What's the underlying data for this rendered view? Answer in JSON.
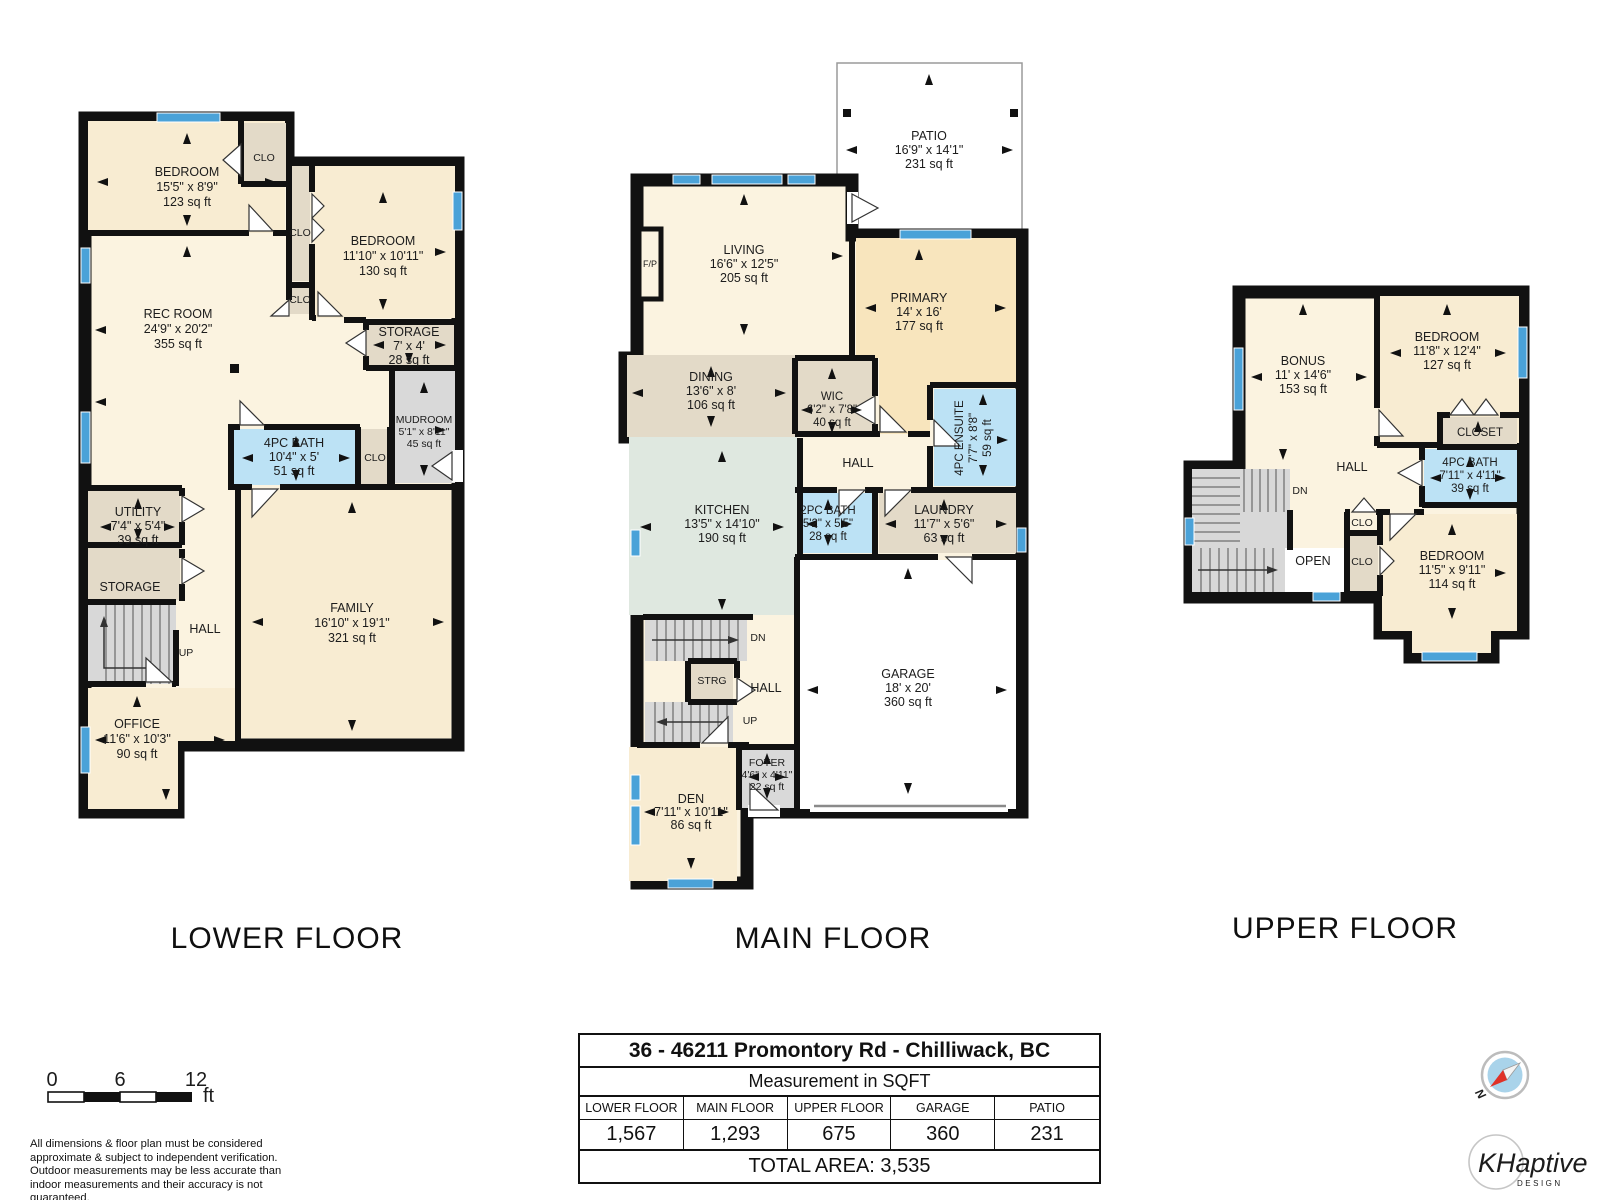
{
  "floors": {
    "lower": {
      "label": "LOWER FLOOR",
      "rooms": {
        "bedroom1": {
          "name": "BEDROOM",
          "dims": "15'5\" x 8'9\"",
          "area": "123 sq ft"
        },
        "clo_bedroom1": {
          "name": "CLO"
        },
        "bedroom2": {
          "name": "BEDROOM",
          "dims": "11'10\" x 10'11\"",
          "area": "130 sq ft"
        },
        "clo_hall_upper": {
          "name": "CLO"
        },
        "clo_hall_lower": {
          "name": "CLO"
        },
        "rec_room": {
          "name": "REC ROOM",
          "dims": "24'9\" x 20'2\"",
          "area": "355 sq ft"
        },
        "storage_right": {
          "name": "STORAGE",
          "dims": "7' x 4'",
          "area": "28 sq ft"
        },
        "mudroom": {
          "name": "MUDROOM",
          "dims": "5'1\" x 8'11\"",
          "area": "45 sq ft"
        },
        "bath": {
          "name": "4PC BATH",
          "dims": "10'4\" x 5'",
          "area": "51 sq ft"
        },
        "clo_bath": {
          "name": "CLO"
        },
        "utility": {
          "name": "UTILITY",
          "dims": "7'4\" x 5'4\"",
          "area": "39 sq ft"
        },
        "storage_left": {
          "name": "STORAGE"
        },
        "hall": {
          "name": "HALL"
        },
        "up": {
          "name": "UP"
        },
        "office": {
          "name": "OFFICE",
          "dims": "11'6\" x 10'3\"",
          "area": "90 sq ft"
        },
        "family": {
          "name": "FAMILY",
          "dims": "16'10\" x 19'1\"",
          "area": "321 sq ft"
        }
      }
    },
    "main": {
      "label": "MAIN FLOOR",
      "rooms": {
        "patio": {
          "name": "PATIO",
          "dims": "16'9\" x 14'1\"",
          "area": "231 sq ft"
        },
        "living": {
          "name": "LIVING",
          "dims": "16'6\" x 12'5\"",
          "area": "205 sq ft"
        },
        "fireplace": {
          "name": "F/P"
        },
        "primary": {
          "name": "PRIMARY",
          "dims": "14' x 16'",
          "area": "177 sq ft"
        },
        "dining": {
          "name": "DINING",
          "dims": "13'6\" x 8'",
          "area": "106 sq ft"
        },
        "wic": {
          "name": "WIC",
          "dims": "6'2\" x 7'8\"",
          "area": "40 sq ft"
        },
        "ensuite": {
          "name": "4PC ENSUITE",
          "dims": "7'7\" x 8'8\"",
          "area": "59 sq ft"
        },
        "hall_upper": {
          "name": "HALL"
        },
        "bath2": {
          "name": "2PC BATH",
          "dims": "5'2\" x 5'5\"",
          "area": "28 sq ft"
        },
        "laundry": {
          "name": "LAUNDRY",
          "dims": "11'7\" x 5'6\"",
          "area": "63 sq ft"
        },
        "kitchen": {
          "name": "KITCHEN",
          "dims": "13'5\" x 14'10\"",
          "area": "190 sq ft"
        },
        "dn": {
          "name": "DN"
        },
        "strg": {
          "name": "STRG"
        },
        "hall_lower": {
          "name": "HALL"
        },
        "up": {
          "name": "UP"
        },
        "garage": {
          "name": "GARAGE",
          "dims": "18' x 20'",
          "area": "360 sq ft"
        },
        "foyer": {
          "name": "FOYER",
          "dims": "4'6\" x 4'11\"",
          "area": "22 sq ft"
        },
        "den": {
          "name": "DEN",
          "dims": "7'11\" x 10'11\"",
          "area": "86 sq ft"
        }
      }
    },
    "upper": {
      "label": "UPPER FLOOR",
      "rooms": {
        "bonus": {
          "name": "BONUS",
          "dims": "11' x 14'6\"",
          "area": "153 sq ft"
        },
        "bedroom1": {
          "name": "BEDROOM",
          "dims": "11'8\" x 12'4\"",
          "area": "127 sq ft"
        },
        "closet": {
          "name": "CLOSET"
        },
        "bath": {
          "name": "4PC BATH",
          "dims": "7'11\" x 4'11\"",
          "area": "39 sq ft"
        },
        "hall": {
          "name": "HALL"
        },
        "dn": {
          "name": "DN"
        },
        "open": {
          "name": "OPEN"
        },
        "clo1": {
          "name": "CLO"
        },
        "clo2": {
          "name": "CLO"
        },
        "bedroom2": {
          "name": "BEDROOM",
          "dims": "11'5\" x 9'11\"",
          "area": "114 sq ft"
        }
      }
    }
  },
  "summary_table": {
    "title": "36 - 46211 Promontory Rd - Chilliwack, BC",
    "subtitle": "Measurement in SQFT",
    "columns": [
      "LOWER FLOOR",
      "MAIN FLOOR",
      "UPPER FLOOR",
      "GARAGE",
      "PATIO"
    ],
    "values": [
      "1,567",
      "1,293",
      "675",
      "360",
      "231"
    ],
    "total": "TOTAL AREA: 3,535"
  },
  "scale_bar": {
    "t0": "0",
    "t6": "6",
    "t12": "12",
    "unit": "ft"
  },
  "disclaimer": "All dimensions & floor plan must be considered approximate & subject to independent verification.  Outdoor measurements may be less accurate than indoor measurements and their accuracy is not guaranteed.",
  "compass": {
    "north_label": "N"
  },
  "logo": {
    "text": "KHaptive",
    "sub": "DESIGN"
  },
  "colors": {
    "wall": "#111111",
    "window": "#4aa2d8",
    "bath": "#bce2f5",
    "tan": "#e3dac8",
    "cream": "#fbf3e0",
    "room_cream": "#f8ecd2",
    "primary": "#f8e5bd",
    "kitchen": "#dfe8e0",
    "gray": "#d9d9d9"
  }
}
